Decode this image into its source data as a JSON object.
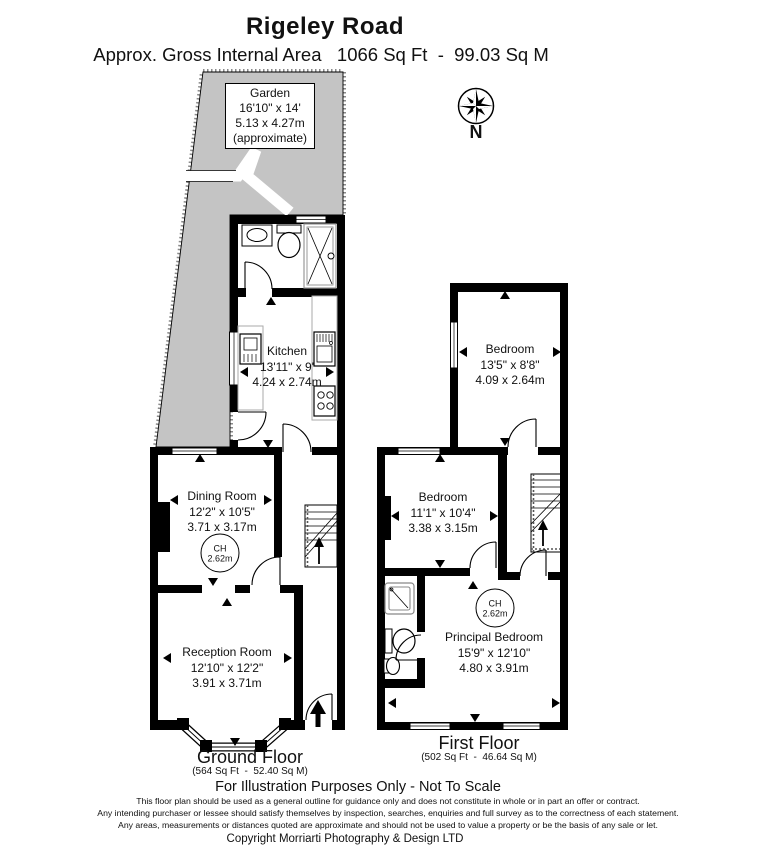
{
  "header": {
    "title": "Rigeley Road",
    "subtitle": "Approx. Gross Internal Area   1066 Sq Ft  -  99.03 Sq M"
  },
  "compass": {
    "north_label": "N"
  },
  "garden": {
    "name": "Garden",
    "dimensions_imperial": "16'10\" x 14'",
    "dimensions_metric": "5.13 x 4.27m",
    "note": "(approximate)"
  },
  "ground_floor": {
    "label": "Ground Floor",
    "area": "(564 Sq Ft  -  52.40 Sq M)",
    "ceiling_height": {
      "label": "CH",
      "value": "2.62m"
    },
    "rooms": {
      "kitchen": {
        "name": "Kitchen",
        "dimensions_imperial": "13'11\" x 9'",
        "dimensions_metric": "4.24 x 2.74m"
      },
      "dining_room": {
        "name": "Dining Room",
        "dimensions_imperial": "12'2\" x 10'5\"",
        "dimensions_metric": "3.71 x 3.17m"
      },
      "reception_room": {
        "name": "Reception Room",
        "dimensions_imperial": "12'10\" x 12'2\"",
        "dimensions_metric": "3.91 x 3.71m"
      }
    }
  },
  "first_floor": {
    "label": "First Floor",
    "area": "(502 Sq Ft  -  46.64 Sq M)",
    "ceiling_height": {
      "label": "CH",
      "value": "2.62m"
    },
    "rooms": {
      "bedroom_rear": {
        "name": "Bedroom",
        "dimensions_imperial": "13'5\" x 8'8\"",
        "dimensions_metric": "4.09 x 2.64m"
      },
      "bedroom_middle": {
        "name": "Bedroom",
        "dimensions_imperial": "11'1\" x 10'4\"",
        "dimensions_metric": "3.38 x 3.15m"
      },
      "principal_bedroom": {
        "name": "Principal Bedroom",
        "dimensions_imperial": "15'9\" x 12'10\"",
        "dimensions_metric": "4.80 x 3.91m"
      }
    }
  },
  "footer": {
    "notice": "For Illustration Purposes Only - Not To Scale",
    "disclaimer_lines": [
      "This floor plan should be used as a general outline for guidance only and does not constitute in whole or in part an offer or contract.",
      "Any intending purchaser or lessee should satisfy themselves by inspection, searches, enquiries and full survey as to the correctness of each statement.",
      "Any areas, measurements or distances quoted are approximate and should not be used to value a property or be the basis of any sale or let."
    ],
    "copyright": "Copyright Morriarti Photography & Design LTD"
  },
  "colors": {
    "wall": "#000000",
    "garden_fill": "#c4c4c4",
    "background": "#ffffff",
    "fixture_outline": "#8a8a8a"
  }
}
